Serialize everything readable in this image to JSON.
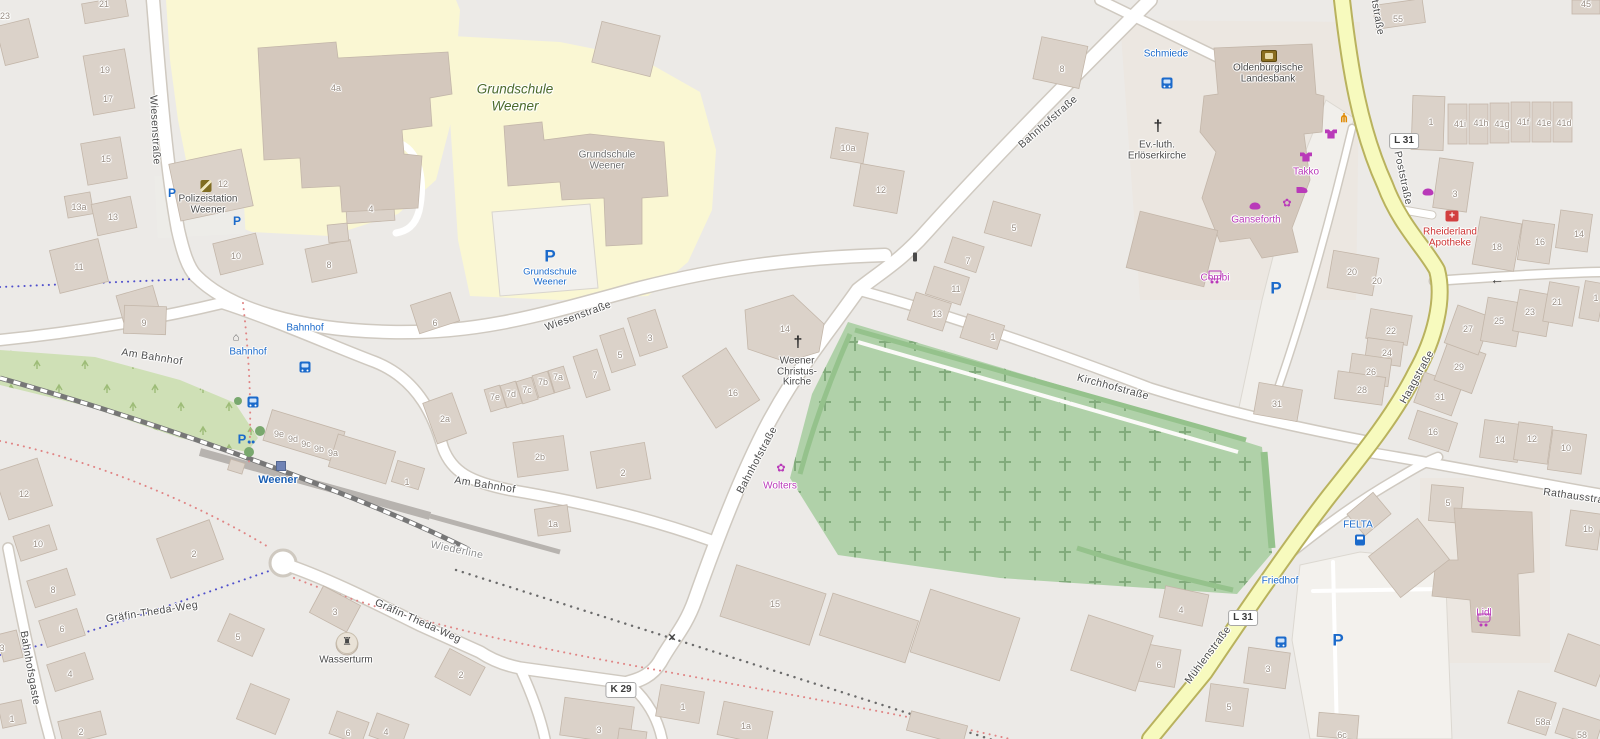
{
  "map": {
    "colors": {
      "background": "#eceae7",
      "road_major_fill": "#f7fabe",
      "school_ground": "#faf7d3",
      "cemetery_green": "#b0d1a9",
      "scrub_green": "#cfe0b6",
      "building_fill": "#dbd2c9",
      "transit_blue": "#1b6acb",
      "shop_magenta": "#b93ab9",
      "health_red": "#cd3434",
      "school_label_green": "#4c6b2a",
      "station_blue": "#1a5fb4"
    },
    "streets": [
      {
        "t": "Wiesenstraße",
        "x": 155,
        "y": 130,
        "r": 87
      },
      {
        "t": "Wiesenstraße",
        "x": 578,
        "y": 316,
        "r": -20
      },
      {
        "t": "Bahnhofstraße",
        "x": 1048,
        "y": 122,
        "r": -41
      },
      {
        "t": "Bahnhofstraße",
        "x": 757,
        "y": 460,
        "r": -62
      },
      {
        "t": "Am Bahnhof",
        "x": 152,
        "y": 357,
        "r": 9
      },
      {
        "t": "Am Bahnhof",
        "x": 485,
        "y": 485,
        "r": 9
      },
      {
        "t": "Kirchhofstraße",
        "x": 1113,
        "y": 387,
        "r": 15
      },
      {
        "t": "Poststraße",
        "x": 1376,
        "y": 8,
        "r": 80
      },
      {
        "t": "Poststraße",
        "x": 1403,
        "y": 178,
        "r": 78
      },
      {
        "t": "Haagstraße",
        "x": 1417,
        "y": 377,
        "r": -61
      },
      {
        "t": "Mühlenstraße",
        "x": 1208,
        "y": 655,
        "r": -53
      },
      {
        "t": "Gräfin-Theda-Weg",
        "x": 152,
        "y": 612,
        "r": -9
      },
      {
        "t": "Gräfin-Theda-Weg",
        "x": 418,
        "y": 621,
        "r": 24
      },
      {
        "t": "Bahnhofsgaste",
        "x": 30,
        "y": 668,
        "r": 80
      },
      {
        "t": "Rathausstraße",
        "x": 1580,
        "y": 497,
        "r": 8
      },
      {
        "t": "Wiederline",
        "x": 457,
        "y": 550,
        "r": 12,
        "cls": "minor"
      }
    ],
    "route_badges": [
      {
        "t": "L 31",
        "x": 1404,
        "y": 141
      },
      {
        "t": "L 31",
        "x": 1243,
        "y": 618
      },
      {
        "t": "K 29",
        "x": 621,
        "y": 690
      }
    ],
    "pois": [
      {
        "name": "grundschule-weener-area",
        "cls": "school-area",
        "x": 515,
        "y": 89,
        "lh": 17,
        "lines": [
          "Grundschule",
          "Weener"
        ]
      },
      {
        "name": "grundschule-weener-building",
        "cls": "building",
        "x": 607,
        "y": 155,
        "lh": 11,
        "lines": [
          "Grundschule",
          "Weener"
        ]
      },
      {
        "name": "polizeistation-weener",
        "cls": "",
        "x": 208,
        "y": 199,
        "lines": [
          "Polizeistation",
          "Weener"
        ],
        "icon": "police",
        "ix": 206,
        "iy": 186
      },
      {
        "name": "weener-christus-kirche",
        "cls": "",
        "x": 797,
        "y": 361,
        "lines": [
          "Weener",
          "Christus-",
          "Kirche"
        ],
        "icon": "cross",
        "ix": 798,
        "iy": 343
      },
      {
        "name": "ev-luth-erloeserkirche",
        "cls": "",
        "x": 1157,
        "y": 145,
        "lines": [
          "Ev.-luth.",
          "Erlöserkirche"
        ],
        "icon": "cross",
        "ix": 1158,
        "iy": 127
      },
      {
        "name": "oldenburgische-landesbank",
        "cls": "",
        "x": 1268,
        "y": 68,
        "lines": [
          "Oldenburgische",
          "Landesbank"
        ],
        "icon": "bank",
        "ix": 1269,
        "iy": 56
      },
      {
        "name": "wasserturm",
        "cls": "",
        "x": 346,
        "y": 660,
        "lines": [
          "Wasserturm"
        ],
        "icon": "tower",
        "ix": 347,
        "iy": 643
      },
      {
        "name": "takko",
        "cls": "shop",
        "x": 1306,
        "y": 172,
        "lines": [
          "Takko"
        ],
        "icon": "shirt",
        "ix": 1306,
        "iy": 157
      },
      {
        "name": "ganseforth",
        "cls": "shop",
        "x": 1256,
        "y": 220,
        "lines": [
          "Ganseforth"
        ],
        "icon": "bread",
        "ix": 1255,
        "iy": 206
      },
      {
        "name": "combi",
        "cls": "shop",
        "x": 1215,
        "y": 278,
        "lines": [
          "Combi"
        ],
        "icon": "cart",
        "ix": 1215,
        "iy": 263
      },
      {
        "name": "wolters",
        "cls": "shop",
        "x": 780,
        "y": 486,
        "lines": [
          "Wolters"
        ],
        "icon": "flower",
        "ix": 781,
        "iy": 469
      },
      {
        "name": "lidl",
        "cls": "shop",
        "x": 1484,
        "y": 613,
        "lines": [
          "Lidl"
        ],
        "icon": "cart",
        "ix": 1484,
        "iy": 597
      },
      {
        "name": "rheiderland-apotheke",
        "cls": "health",
        "x": 1450,
        "y": 232,
        "lines": [
          "Rheiderland",
          "Apotheke"
        ],
        "icon": "pharmacy",
        "ix": 1452,
        "iy": 216
      },
      {
        "name": "felta",
        "cls": "transit",
        "x": 1358,
        "y": 525,
        "lines": [
          "FELTA"
        ],
        "icon": "fuel",
        "ix": 1360,
        "iy": 510
      },
      {
        "name": "schmiede-stop",
        "cls": "transit",
        "x": 1166,
        "y": 54,
        "lines": [
          "Schmiede"
        ],
        "icon": "bus",
        "ix": 1167,
        "iy": 42
      },
      {
        "name": "bahnhof-stop-upper",
        "cls": "transit",
        "x": 305,
        "y": 328,
        "lines": [
          "Bahnhof"
        ],
        "icon": "bus",
        "ix": 305,
        "iy": 315
      },
      {
        "name": "bahnhof-stop-lower",
        "cls": "transit",
        "x": 248,
        "y": 352,
        "lines": [
          "Bahnhof"
        ],
        "icon": "bus",
        "ix": 253,
        "iy": 339,
        "icon2": "hut",
        "ix2": 236,
        "iy2": 338
      },
      {
        "name": "friedhof-stop",
        "cls": "transit",
        "x": 1280,
        "y": 581,
        "lines": [
          "Friedhof"
        ],
        "icon": "bus",
        "ix": 1281,
        "iy": 568
      },
      {
        "name": "weener-station",
        "cls": "station",
        "x": 278,
        "y": 480,
        "lines": [
          "Weener"
        ],
        "icon": "rail",
        "ix": 281,
        "iy": 466
      }
    ],
    "parking": [
      {
        "x": 172,
        "y": 193,
        "s": 12
      },
      {
        "x": 237,
        "y": 221,
        "s": 12
      },
      {
        "x": 550,
        "y": 256,
        "s": 17,
        "lines": [
          "Grundschule",
          "Weener"
        ],
        "lx": 550,
        "ly": 272
      },
      {
        "x": 1276,
        "y": 288,
        "s": 17
      },
      {
        "x": 1338,
        "y": 640,
        "s": 17
      },
      {
        "x": 246,
        "y": 439,
        "s": 13,
        "bike": true
      }
    ],
    "icons": [
      {
        "type": "restaurant",
        "x": 1344,
        "y": 118
      },
      {
        "type": "shirt",
        "x": 1331,
        "y": 134
      },
      {
        "type": "shoes",
        "x": 1302,
        "y": 190
      },
      {
        "type": "flower",
        "x": 1287,
        "y": 204
      },
      {
        "type": "bread",
        "x": 1428,
        "y": 192
      },
      {
        "type": "signal",
        "x": 915,
        "y": 257
      },
      {
        "type": "xing",
        "x": 672,
        "y": 637
      },
      {
        "type": "arrow-left",
        "x": 1497,
        "y": 279
      }
    ],
    "house_numbers": [
      {
        "t": "23",
        "x": 5,
        "y": 16
      },
      {
        "t": "21",
        "x": 104,
        "y": 4
      },
      {
        "t": "19",
        "x": 105,
        "y": 70
      },
      {
        "t": "17",
        "x": 108,
        "y": 99
      },
      {
        "t": "15",
        "x": 106,
        "y": 159
      },
      {
        "t": "13a",
        "x": 79,
        "y": 207
      },
      {
        "t": "13",
        "x": 113,
        "y": 217
      },
      {
        "t": "11",
        "x": 79,
        "y": 267
      },
      {
        "t": "12",
        "x": 223,
        "y": 184
      },
      {
        "t": "4a",
        "x": 336,
        "y": 88
      },
      {
        "t": "4",
        "x": 371,
        "y": 209
      },
      {
        "t": "10",
        "x": 236,
        "y": 256
      },
      {
        "t": "8",
        "x": 329,
        "y": 265
      },
      {
        "t": "6",
        "x": 435,
        "y": 323
      },
      {
        "t": "9",
        "x": 144,
        "y": 323
      },
      {
        "t": "7e",
        "x": 495,
        "y": 397
      },
      {
        "t": "7d",
        "x": 511,
        "y": 394
      },
      {
        "t": "7c",
        "x": 527,
        "y": 390
      },
      {
        "t": "7b",
        "x": 543,
        "y": 382
      },
      {
        "t": "7a",
        "x": 558,
        "y": 377
      },
      {
        "t": "7",
        "x": 595,
        "y": 375
      },
      {
        "t": "5",
        "x": 620,
        "y": 355
      },
      {
        "t": "3",
        "x": 650,
        "y": 338
      },
      {
        "t": "2a",
        "x": 445,
        "y": 419
      },
      {
        "t": "2b",
        "x": 540,
        "y": 457
      },
      {
        "t": "2",
        "x": 623,
        "y": 473
      },
      {
        "t": "1a",
        "x": 553,
        "y": 524
      },
      {
        "t": "16",
        "x": 733,
        "y": 393
      },
      {
        "t": "14",
        "x": 785,
        "y": 329
      },
      {
        "t": "10a",
        "x": 848,
        "y": 148
      },
      {
        "t": "12",
        "x": 881,
        "y": 190
      },
      {
        "t": "8",
        "x": 1062,
        "y": 69
      },
      {
        "t": "5",
        "x": 1014,
        "y": 228
      },
      {
        "t": "7",
        "x": 968,
        "y": 261
      },
      {
        "t": "11",
        "x": 956,
        "y": 289
      },
      {
        "t": "13",
        "x": 937,
        "y": 314
      },
      {
        "t": "1",
        "x": 993,
        "y": 337
      },
      {
        "t": "9e",
        "x": 279,
        "y": 434
      },
      {
        "t": "9d",
        "x": 293,
        "y": 439
      },
      {
        "t": "9c",
        "x": 306,
        "y": 444
      },
      {
        "t": "9b",
        "x": 319,
        "y": 449
      },
      {
        "t": "9a",
        "x": 333,
        "y": 453
      },
      {
        "t": "1",
        "x": 407,
        "y": 482
      },
      {
        "t": "12",
        "x": 24,
        "y": 494
      },
      {
        "t": "10",
        "x": 38,
        "y": 544
      },
      {
        "t": "2",
        "x": 194,
        "y": 554
      },
      {
        "t": "8",
        "x": 53,
        "y": 590
      },
      {
        "t": "6",
        "x": 62,
        "y": 629
      },
      {
        "t": "3",
        "x": 2,
        "y": 648
      },
      {
        "t": "4",
        "x": 70,
        "y": 674
      },
      {
        "t": "1",
        "x": 12,
        "y": 719
      },
      {
        "t": "2",
        "x": 81,
        "y": 732
      },
      {
        "t": "3",
        "x": 335,
        "y": 612
      },
      {
        "t": "5",
        "x": 238,
        "y": 637
      },
      {
        "t": "2",
        "x": 461,
        "y": 675
      },
      {
        "t": "6",
        "x": 348,
        "y": 733
      },
      {
        "t": "4",
        "x": 386,
        "y": 732
      },
      {
        "t": "15",
        "x": 775,
        "y": 604
      },
      {
        "t": "1",
        "x": 683,
        "y": 707
      },
      {
        "t": "1a",
        "x": 746,
        "y": 726
      },
      {
        "t": "3",
        "x": 599,
        "y": 730
      },
      {
        "t": "55",
        "x": 1398,
        "y": 19
      },
      {
        "t": "45",
        "x": 1586,
        "y": 4
      },
      {
        "t": "41i",
        "x": 1460,
        "y": 124
      },
      {
        "t": "41h",
        "x": 1481,
        "y": 123
      },
      {
        "t": "41g",
        "x": 1502,
        "y": 124
      },
      {
        "t": "41f",
        "x": 1523,
        "y": 122
      },
      {
        "t": "41e",
        "x": 1544,
        "y": 123
      },
      {
        "t": "41d",
        "x": 1564,
        "y": 123
      },
      {
        "t": "1",
        "x": 1431,
        "y": 122
      },
      {
        "t": "3",
        "x": 1455,
        "y": 194
      },
      {
        "t": "18",
        "x": 1497,
        "y": 247
      },
      {
        "t": "16",
        "x": 1540,
        "y": 242
      },
      {
        "t": "14",
        "x": 1579,
        "y": 234
      },
      {
        "t": "20",
        "x": 1377,
        "y": 281
      },
      {
        "t": "22",
        "x": 1391,
        "y": 331
      },
      {
        "t": "24",
        "x": 1387,
        "y": 353
      },
      {
        "t": "26",
        "x": 1371,
        "y": 372
      },
      {
        "t": "28",
        "x": 1362,
        "y": 390
      },
      {
        "t": "31",
        "x": 1277,
        "y": 404
      },
      {
        "t": "31",
        "x": 1440,
        "y": 397
      },
      {
        "t": "16",
        "x": 1433,
        "y": 432
      },
      {
        "t": "29",
        "x": 1459,
        "y": 367
      },
      {
        "t": "27",
        "x": 1468,
        "y": 329
      },
      {
        "t": "25",
        "x": 1499,
        "y": 321
      },
      {
        "t": "23",
        "x": 1530,
        "y": 312
      },
      {
        "t": "21",
        "x": 1557,
        "y": 302
      },
      {
        "t": "1",
        "x": 1596,
        "y": 298
      },
      {
        "t": "14",
        "x": 1500,
        "y": 440
      },
      {
        "t": "12",
        "x": 1532,
        "y": 439
      },
      {
        "t": "10",
        "x": 1566,
        "y": 448
      },
      {
        "t": "5",
        "x": 1448,
        "y": 503
      },
      {
        "t": "1b",
        "x": 1588,
        "y": 529
      },
      {
        "t": "58a",
        "x": 1543,
        "y": 722
      },
      {
        "t": "58",
        "x": 1582,
        "y": 735
      },
      {
        "t": "6c",
        "x": 1342,
        "y": 735
      },
      {
        "t": "4",
        "x": 1181,
        "y": 610
      },
      {
        "t": "6",
        "x": 1159,
        "y": 665
      },
      {
        "t": "3",
        "x": 1268,
        "y": 669
      },
      {
        "t": "5",
        "x": 1229,
        "y": 707
      },
      {
        "t": "20",
        "x": 1352,
        "y": 272
      }
    ]
  }
}
